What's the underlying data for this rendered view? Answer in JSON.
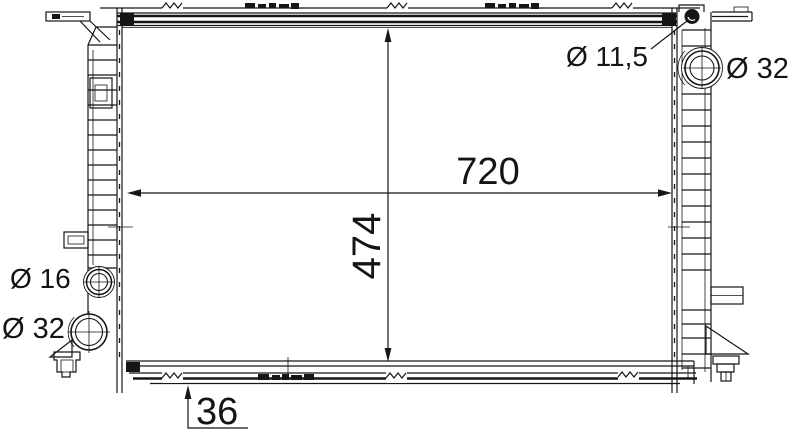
{
  "drawing": {
    "type": "radiator-technical-drawing",
    "colors": {
      "line": "#161616",
      "background": "#ffffff"
    },
    "dimensions": {
      "width_label": "720",
      "height_label": "474",
      "depth_label": "36"
    },
    "callouts": {
      "mount_hole": "Ø 11,5",
      "top_right_port": "Ø 32",
      "left_small_port": "Ø 16",
      "left_large_port": "Ø 32"
    }
  }
}
